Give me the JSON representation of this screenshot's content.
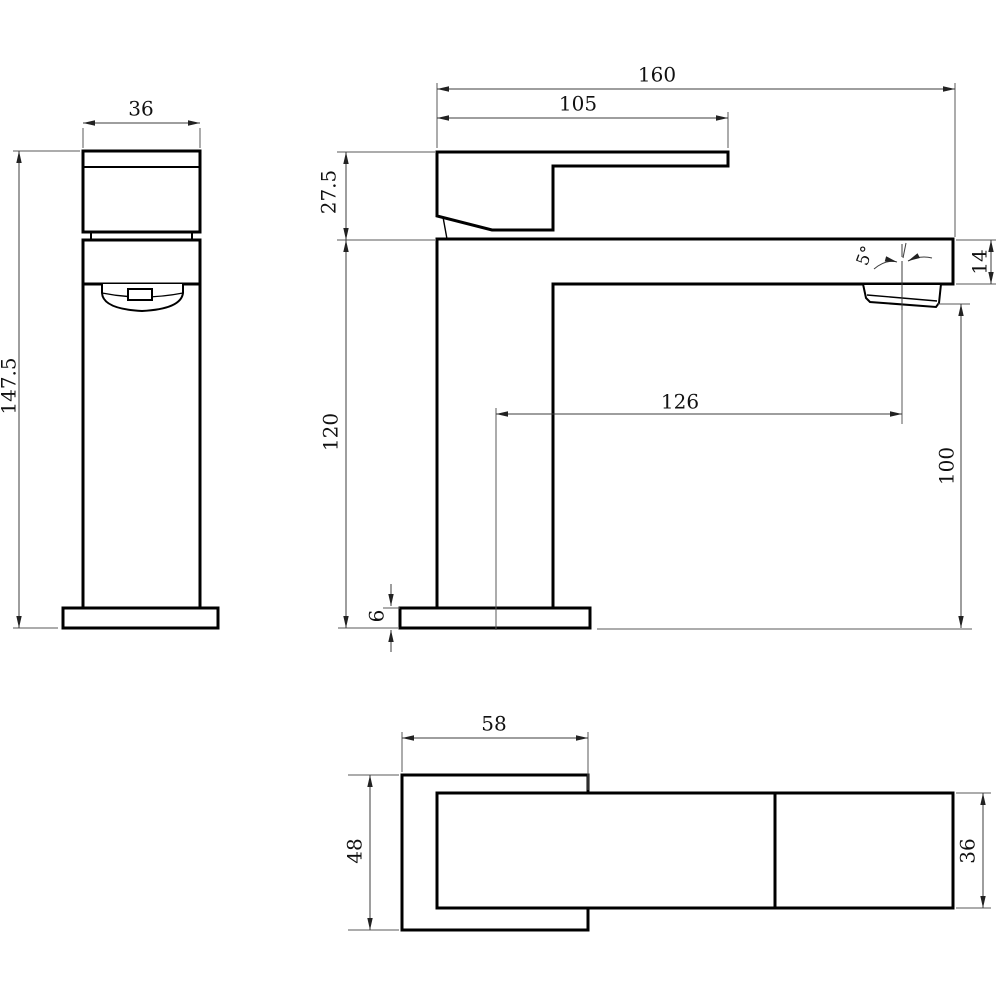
{
  "page": {
    "background": "#ffffff"
  },
  "drawing": {
    "type": "faucet-three-view-technical-drawing",
    "line_color": "#000000",
    "dim_line_color": "#3c3c3c",
    "text_color": "#111111",
    "views": {
      "front": {
        "dims": {
          "width": "36",
          "total_height": "147.5"
        }
      },
      "side": {
        "dims": {
          "total_length": "160",
          "handle_length": "105",
          "handle_height": "27.5",
          "spout_angle": "5°",
          "spout_end_height": "14",
          "spout_reach": "126",
          "outlet_clearance": "100",
          "body_height": "120",
          "base_thickness": "6"
        }
      },
      "top": {
        "dims": {
          "base_length": "58",
          "base_width": "48",
          "spout_width": "36"
        }
      }
    }
  }
}
